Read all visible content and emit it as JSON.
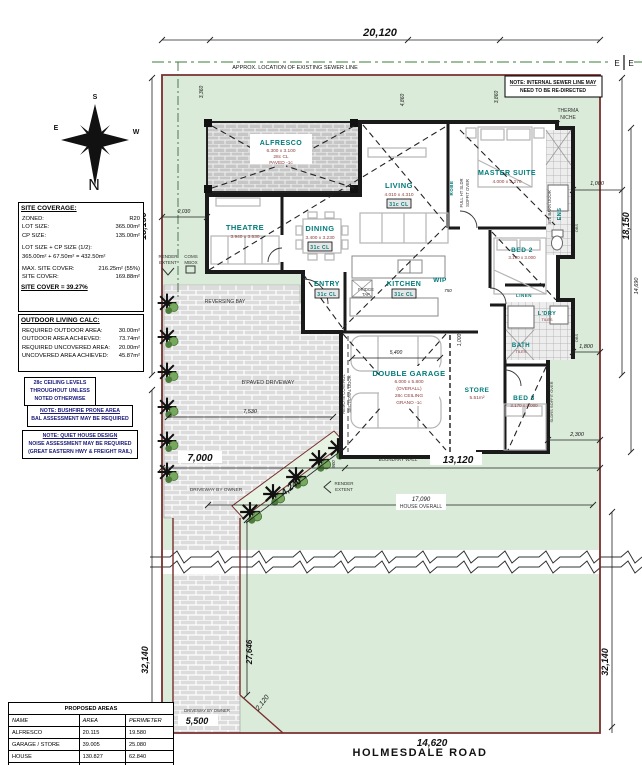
{
  "top": {
    "dim": "20,120",
    "seg1": "3,360",
    "seg2": "4,860",
    "seg3": "3,860",
    "sewer_note": "APPROX. LOCATION OF EXISTING SEWER LINE",
    "marker_l": "E",
    "marker_r": "E",
    "internal_sewer_1": "NOTE: INTERNAL SEWER LINE MAY",
    "internal_sewer_2": "NEED TO BE RE-DIRECTED",
    "therma_1": "THERMA",
    "therma_2": "NICHE"
  },
  "sides": {
    "left_upper": "18,150",
    "right_upper": "18,150",
    "right_inner": "14,690",
    "right_1000": "1,000",
    "right_1800": "1,800",
    "right_2300": "2,300",
    "left_2030": "2,030",
    "left_lower": "32,140",
    "right_lower": "32,140",
    "leg": "27,646",
    "splay": "2,120",
    "strip_width": "5,500",
    "bottom": "14,620"
  },
  "front": {
    "d7000": "7,000",
    "d13120": "13,120",
    "d7530": "7,530",
    "d4240": "4,240",
    "d17090": "17,090",
    "house_overall": "HOUSE OVERALL",
    "boundary_wall": "BOUNDARY WALL",
    "d900": "900"
  },
  "inner_dims": {
    "garage_w": "5,400",
    "garage_r": "1,000",
    "wip": "750"
  },
  "rooms": {
    "alfresco": {
      "name": "ALFRESCO",
      "size": "6.300 x 3.100",
      "ceiling": "28c CL",
      "floor": "PAVED -1c"
    },
    "theatre": {
      "name": "THEATRE",
      "size": "3.940 x 3.530"
    },
    "dining": {
      "name": "DINING",
      "size": "3.400 x 3.230",
      "ceiling": "31c CL"
    },
    "living": {
      "name": "LIVING",
      "size": "4.010 x 4.310",
      "ceiling": "31c CL"
    },
    "master": {
      "name": "MASTER SUITE",
      "size": "4.000 x 3.270"
    },
    "bed2": {
      "name": "BED 2",
      "size": "3.170 x 3.000"
    },
    "bed3": {
      "name": "BED 3",
      "size": "3.170 x 3.000"
    },
    "entry": {
      "name": "ENTRY",
      "ceiling": "31c CL"
    },
    "kitchen": {
      "name": "KITCHEN",
      "ceiling": "31c CL"
    },
    "wip": {
      "name": "WIP"
    },
    "ens": {
      "name": "ENS"
    },
    "bath": {
      "name": "BATH",
      "floor": "TILES"
    },
    "ldry": {
      "name": "L'DRY",
      "floor": "TILES"
    },
    "linen": {
      "name": "LINEN"
    },
    "robe": {
      "name": "ROBE"
    },
    "store": {
      "name": "STORE",
      "area": "5.51m²"
    },
    "garage": {
      "name": "DOUBLE GARAGE",
      "size": "6.000 x 5.800",
      "note": "(OVERALL)",
      "ceiling": "28c CEILING",
      "floor": "GRANO -1c"
    }
  },
  "annotations": {
    "remote_1": "REMOTE CONTROL",
    "remote_2": "SECTIONAL DOOR",
    "sldr_1": "FULL HT SLDR",
    "sldr_2": "SOFFIT OVER",
    "barn_door": "870 BARN DOOR",
    "sldrs": "SLDRS SOFFIT OVER",
    "fridge_1": "FRIDGE",
    "fridge_2": "TAP",
    "obs": "OBS",
    "bpaved": "B'PAVED DRIVEWAY",
    "reversing": "REVERSING BAY",
    "driveway_owner": "DRIVEWAY BY OWNER",
    "render_1": "RENDER",
    "render_2": "EXTENT",
    "coms_1": "COMS",
    "coms_2": "MBOX"
  },
  "site_coverage": {
    "title": "SITE COVERAGE:",
    "rows": [
      {
        "label": "ZONED:",
        "value": "R20"
      },
      {
        "label": "LOT SIZE:",
        "value": "365.00m²"
      },
      {
        "label": "CP SIZE:",
        "value": "135.00m²"
      }
    ],
    "formula_label": "LOT SIZE + CP SIZE (1/2):",
    "formula": "365.00m² + 67.50m² = 432.50m²",
    "rows2": [
      {
        "label": "MAX. SITE COVER:",
        "value": "216.25m² (55%)"
      },
      {
        "label": "SITE COVER:",
        "value": "169.88m²"
      }
    ],
    "result": "SITE COVER = 39.27%"
  },
  "outdoor_living": {
    "title": "OUTDOOR LIVING CALC:",
    "rows": [
      {
        "label": "REQUIRED OUTDOOR AREA:",
        "value": "30.00m²"
      },
      {
        "label": "OUTDOOR AREA ACHIEVED:",
        "value": "73.74m²"
      },
      {
        "label": "REQUIRED UNCOVERED AREA:",
        "value": "20.00m²"
      },
      {
        "label": "UNCOVERED AREA ACHIEVED:",
        "value": "45.87m²"
      }
    ]
  },
  "notes": {
    "ceiling": [
      "28c CEILING LEVELS",
      "THROUGHOUT UNLESS",
      "NOTED OTHERWISE"
    ],
    "bushfire": [
      "NOTE: BUSHFIRE PRONE AREA",
      "BAL ASSESSMENT MAY BE REQUIRED"
    ],
    "quiet": [
      "NOTE: QUIET HOUSE DESIGN",
      "NOISE ASSESSMENT MAY BE REQUIRED",
      "(GREAT EASTERN HWY & FREIGHT RAIL)"
    ]
  },
  "proposed_areas": {
    "title": "PROPOSED AREAS",
    "headers": [
      "NAME",
      "AREA",
      "PERIMETER"
    ],
    "rows": [
      [
        "ALFRESCO",
        "20.115",
        "19.580"
      ],
      [
        "GARAGE / STORE",
        "39.005",
        "25.080"
      ],
      [
        "HOUSE",
        "130.827",
        "62.840"
      ]
    ],
    "total": "189.947m²"
  },
  "compass": {
    "n": "N",
    "s": "S",
    "e": "E",
    "w": "W"
  },
  "road_name": "HOLMESDALE ROAD",
  "colors": {
    "room_label": "#007a7a",
    "room_dim": "#8b3a3a",
    "boundary": "#7a2e2e",
    "site_fill": "#daecd9",
    "note_text": "#1a1a7a"
  }
}
